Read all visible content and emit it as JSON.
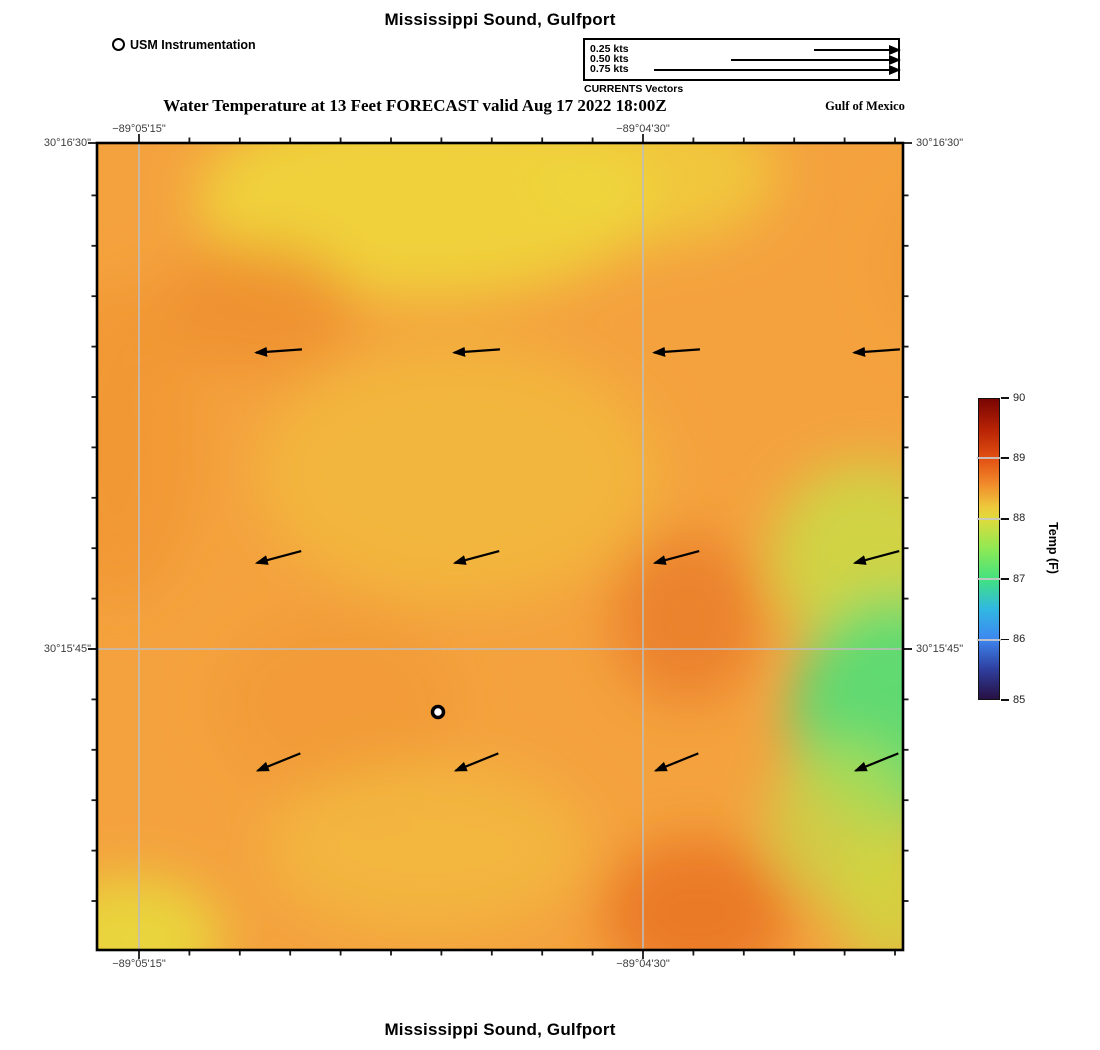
{
  "header": {
    "title": "Mississippi Sound, Gulfport",
    "subtitle": "Water Temperature at 13 Feet FORECAST valid Aug 17 2022 18:00Z",
    "region_label": "Gulf of Mexico",
    "instrument_label": "USM Instrumentation"
  },
  "legend": {
    "caption": "CURRENTS Vectors",
    "rows": [
      {
        "label": "0.25 kts",
        "line_width": 88,
        "top": 9
      },
      {
        "label": "0.50 kts",
        "line_width": 171,
        "top": 19
      },
      {
        "label": "0.75 kts",
        "line_width": 248,
        "top": 29
      }
    ]
  },
  "axes": {
    "top": [
      {
        "text": "−89°05'15\"",
        "x": 139
      },
      {
        "text": "−89°04'30\"",
        "x": 643
      }
    ],
    "bottom": [
      {
        "text": "−89°05'15\"",
        "x": 139
      },
      {
        "text": "−89°04'30\"",
        "x": 643
      }
    ],
    "left": [
      {
        "text": "30°16'30\"",
        "y": 143
      },
      {
        "text": "30°15'45\"",
        "y": 649
      }
    ],
    "right": [
      {
        "text": "30°16'30\"",
        "y": 143
      },
      {
        "text": "30°15'45\"",
        "y": 649
      }
    ]
  },
  "colorbar": {
    "title": "Temp (F)",
    "ticks": [
      "90",
      "89",
      "88",
      "87",
      "86",
      "85"
    ],
    "min": 85,
    "max": 90,
    "stops": [
      [
        "#7a0403",
        0
      ],
      [
        "#b62204",
        10
      ],
      [
        "#e35112",
        20
      ],
      [
        "#f0882a",
        28
      ],
      [
        "#eec93c",
        36
      ],
      [
        "#dfdb3b",
        40
      ],
      [
        "#8ee954",
        50
      ],
      [
        "#42e27f",
        60
      ],
      [
        "#31b8e2",
        70
      ],
      [
        "#3d87f0",
        80
      ],
      [
        "#2f3f9f",
        90
      ],
      [
        "#271043",
        100
      ]
    ]
  },
  "footer": {
    "title": "Mississippi Sound, Gulfport"
  },
  "chart_data": {
    "type": "heatmap",
    "title": "Mississippi Sound, Gulfport",
    "subtitle": "Water Temperature at 13 Feet FORECAST valid Aug 17 2022 18:00Z",
    "region": "Gulf of Mexico",
    "variable": "Water temperature at 13 feet depth (forecast)",
    "valid_time": "Aug 17 2022 18:00Z",
    "colorbar_label": "Temp (F)",
    "colorbar_range": [
      85,
      90
    ],
    "colorbar_tick_values": [
      90,
      89,
      88,
      87,
      86,
      85
    ],
    "x_gridlines": [
      {
        "label": "−89°05'15\"",
        "px": 42
      },
      {
        "label": "−89°04'30\"",
        "px": 546
      }
    ],
    "y_gridlines": [
      {
        "label": "30°16'30\"",
        "px": 0
      },
      {
        "label": "30°15'45\"",
        "px": 506
      }
    ],
    "field_summary": {
      "background_F": 88.4,
      "features": [
        {
          "area": "top-center",
          "approx_F": 88.0,
          "appearance": "yellow"
        },
        {
          "area": "upper-left",
          "approx_F": 88.7,
          "appearance": "darker orange"
        },
        {
          "area": "center-right",
          "approx_F": 88.8,
          "appearance": "orange-red"
        },
        {
          "area": "right-middle-edge",
          "approx_F": 87.2,
          "appearance": "green"
        },
        {
          "area": "right-edge-band",
          "approx_F": 87.8,
          "appearance": "yellow-green"
        },
        {
          "area": "bottom-center-right",
          "approx_F": 88.8,
          "appearance": "orange-red"
        },
        {
          "area": "bottom-left-corner",
          "approx_F": 88.0,
          "appearance": "yellow"
        }
      ]
    },
    "station": {
      "name": "USM Instrumentation",
      "map_x": 341,
      "map_y": 569
    },
    "current_vectors": {
      "legend_kts": [
        0.25,
        0.5,
        0.75
      ],
      "direction": "westward (arrows point left, tilting down-left toward bottom rows)",
      "rows": [
        {
          "y": 208,
          "angle_deg": 4
        },
        {
          "y": 414,
          "angle_deg": 15
        },
        {
          "y": 619,
          "angle_deg": 22
        }
      ],
      "cols_x": [
        182,
        380,
        580,
        780
      ],
      "arrow_len": 46
    },
    "render": {
      "map_w": 806,
      "map_h": 807,
      "pad": 12,
      "base_color": "#F4A23E",
      "grid_color": "#bdbdbd",
      "blobs": [
        {
          "cx": 330,
          "cy": 55,
          "rx": 230,
          "ry": 100,
          "fill": "#EFD63C",
          "op": 0.9
        },
        {
          "cx": 560,
          "cy": 30,
          "rx": 120,
          "ry": 70,
          "fill": "#EFD63C",
          "op": 0.7
        },
        {
          "cx": 160,
          "cy": 165,
          "rx": 100,
          "ry": 65,
          "fill": "#EE8E2F",
          "op": 0.75
        },
        {
          "cx": 20,
          "cy": 300,
          "rx": 80,
          "ry": 160,
          "fill": "#F0932F",
          "op": 0.6
        },
        {
          "cx": 360,
          "cy": 330,
          "rx": 200,
          "ry": 130,
          "fill": "#F2B93D",
          "op": 0.85
        },
        {
          "cx": 240,
          "cy": 560,
          "rx": 120,
          "ry": 90,
          "fill": "#EF942F",
          "op": 0.5
        },
        {
          "cx": 590,
          "cy": 475,
          "rx": 75,
          "ry": 85,
          "fill": "#EA7C28",
          "op": 0.85
        },
        {
          "cx": 770,
          "cy": 415,
          "rx": 95,
          "ry": 95,
          "fill": "#CADC44",
          "op": 0.85
        },
        {
          "cx": 800,
          "cy": 570,
          "rx": 105,
          "ry": 115,
          "fill": "#58DC74",
          "op": 0.95
        },
        {
          "cx": 745,
          "cy": 680,
          "rx": 75,
          "ry": 80,
          "fill": "#C4DC48",
          "op": 0.7
        },
        {
          "cx": 795,
          "cy": 760,
          "rx": 55,
          "ry": 70,
          "fill": "#CCDC40",
          "op": 0.75
        },
        {
          "cx": 600,
          "cy": 770,
          "rx": 95,
          "ry": 75,
          "fill": "#E8711F",
          "op": 0.8
        },
        {
          "cx": 880,
          "cy": 120,
          "rx": 90,
          "ry": 90,
          "fill": "#EE9A33",
          "op": 0.6
        },
        {
          "cx": 330,
          "cy": 705,
          "rx": 160,
          "ry": 85,
          "fill": "#F2BE3E",
          "op": 0.7
        },
        {
          "cx": 35,
          "cy": 795,
          "rx": 90,
          "ry": 60,
          "fill": "#E9D83B",
          "op": 0.95
        }
      ],
      "ticks": {
        "x_start": 42,
        "x_step": 50.4,
        "x_count": 16,
        "y_start": 52.4,
        "y_step": 50.4,
        "y_count": 15,
        "len_minor": 5.5,
        "len_major": 9
      }
    }
  }
}
